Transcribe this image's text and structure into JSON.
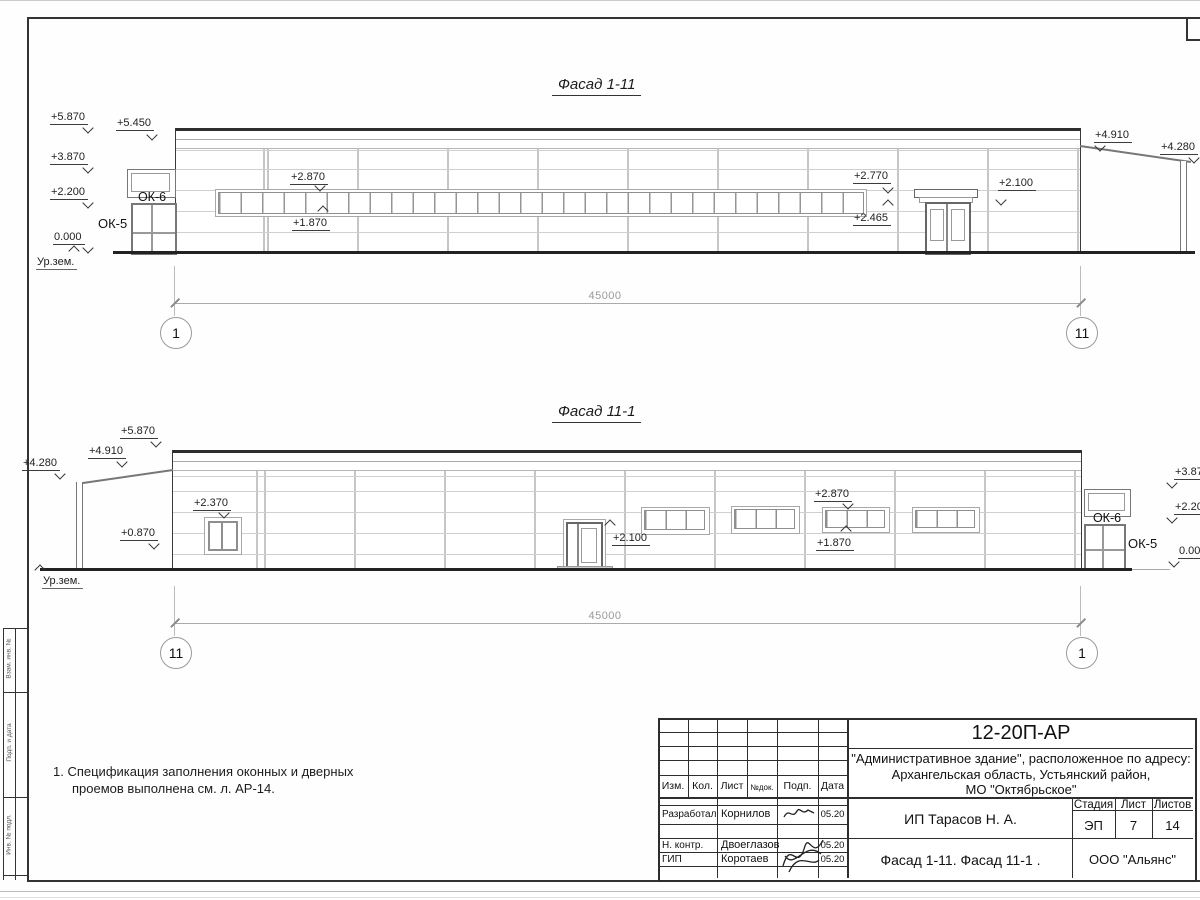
{
  "drawing": {
    "facade_top": {
      "title": "Фасад 1-11",
      "dim": "45000",
      "axis_left": "1",
      "axis_right": "11",
      "marks": {
        "m5870": "+5.870",
        "m5450": "+5.450",
        "m3870": "+3.870",
        "m2200": "+2.200",
        "m0000": "0.000",
        "ur_zem": "Ур.зем.",
        "ok6": "ОК-6",
        "ok5": "ОК-5",
        "m2870": "+2.870",
        "m1870": "+1.870",
        "m2770": "+2.770",
        "m2465": "+2.465",
        "m2100": "+2.100",
        "m4910": "+4.910",
        "m4280": "+4.280"
      }
    },
    "facade_bottom": {
      "title": "Фасад 11-1",
      "dim": "45000",
      "axis_left": "11",
      "axis_right": "1",
      "marks": {
        "m4280": "+4.280",
        "m4910": "+4.910",
        "m5870": "+5.870",
        "m2370": "+2.370",
        "m0870": "+0.870",
        "ur_zem": "Ур.зем.",
        "m2100": "+2.100",
        "m2870": "+2.870",
        "m1870": "+1.870",
        "ok6": "ОК-6",
        "ok5": "ОК-5",
        "m3870": "+3.870",
        "m2200": "+2.200",
        "m0000": "0.000"
      }
    },
    "note_line1": "1. Спецификация заполнения оконных и дверных",
    "note_line2": "проемов выполнена см. л. АР-14."
  },
  "title_block": {
    "code": "12-20П-АР",
    "object_line1": "\"Административное здание\", расположенное по адресу:",
    "object_line2": "Архангельская область, Устьянский район,",
    "object_line3": "МО \"Октябрьское\"",
    "col_izm": "Изм.",
    "col_kol": "Кол.",
    "col_list": "Лист",
    "col_ndok": "№док.",
    "col_podp": "Подп.",
    "col_data": "Дата",
    "client": "ИП Тарасов Н. А.",
    "stage_label": "Стадия",
    "sheet_label": "Лист",
    "sheets_label": "Листов",
    "stage": "ЭП",
    "sheet": "7",
    "sheets": "14",
    "doc_title": "Фасад 1-11. Фасад 11-1 .",
    "company": "ООО \"Альянс\"",
    "row1_role": "Разработал",
    "row1_name": "Корнилов",
    "row1_date": "05.20",
    "row2_role": "Н. контр.",
    "row2_name": "Двоеглазов",
    "row2_date": "05.20",
    "row3_role": "ГИП",
    "row3_name": "Коротаев",
    "row3_date": "05.20"
  },
  "side_stamp": {
    "box1": "Взам. инв. №",
    "box2": "Подп. и дата",
    "box3": "Инв. № подл."
  }
}
